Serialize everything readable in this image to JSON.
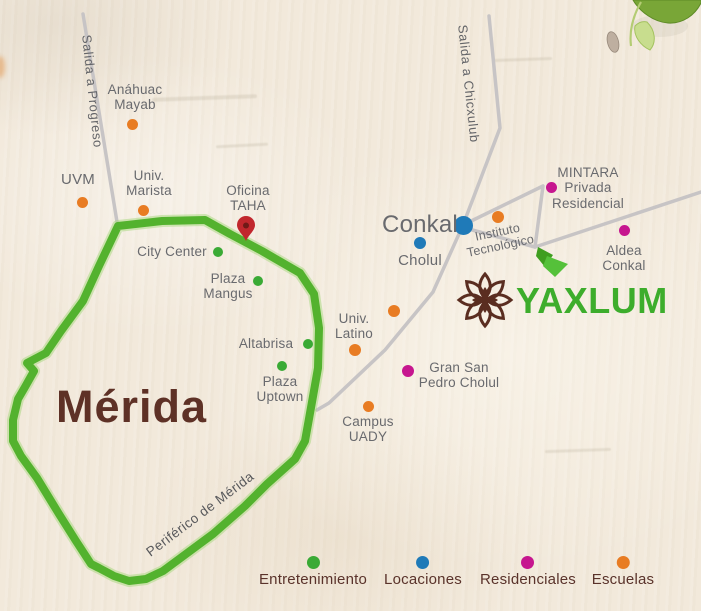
{
  "city_label": "Mérida",
  "ring_label": "Periférico de Mérida",
  "ring_label_pos": {
    "x": 200,
    "y": 514,
    "rotate": -37
  },
  "ring_color": "#53b22e",
  "road_color": "#c7c4c5",
  "road_labels": [
    {
      "id": "salida-progreso",
      "text": "Salida a Progreso",
      "x": 94,
      "y": 34,
      "rotate": 84
    },
    {
      "id": "salida-chicxulub",
      "text": "Salida a Chicxulub",
      "x": 470,
      "y": 24,
      "rotate": 84
    }
  ],
  "office": {
    "lines": [
      "Oficina",
      "TAHA"
    ],
    "label_x": 248,
    "label_y": 183,
    "pin_x": 246,
    "pin_y": 241,
    "pin_color": "#c1272d",
    "pin_hole_color": "#701a17"
  },
  "brand": {
    "name": "YAXLUM",
    "text_color": "#3dad2c",
    "flower_color": "#5a2d20"
  },
  "categories": [
    {
      "id": "entertainment",
      "label": "Entretenimiento",
      "color": "#3aaa35",
      "legend_x": 313
    },
    {
      "id": "location",
      "label": "Locaciones",
      "color": "#1f7ab8",
      "legend_x": 423
    },
    {
      "id": "residential",
      "label": "Residenciales",
      "color": "#c6168f",
      "legend_x": 528
    },
    {
      "id": "school",
      "label": "Escuelas",
      "color": "#e87c23",
      "legend_x": 623
    }
  ],
  "legend": {
    "dot_top": 556,
    "label_top": 571
  },
  "locations": [
    {
      "id": "anahuac-mayab",
      "category": "school",
      "lines": [
        "Anáhuac",
        "Mayab"
      ],
      "dot": {
        "x": 132,
        "y": 124,
        "r": 5.5
      },
      "label": {
        "x": 135,
        "y": 82,
        "size": 13.5
      }
    },
    {
      "id": "uvm",
      "category": "school",
      "lines": [
        "UVM"
      ],
      "dot": {
        "x": 82,
        "y": 202,
        "r": 5.5
      },
      "label": {
        "x": 78,
        "y": 172,
        "size": 15
      }
    },
    {
      "id": "univ-marista",
      "category": "school",
      "lines": [
        "Univ.",
        "Marista"
      ],
      "dot": {
        "x": 143,
        "y": 210,
        "r": 5.5
      },
      "label": {
        "x": 149,
        "y": 168,
        "size": 13.5
      }
    },
    {
      "id": "city-center",
      "category": "entertainment",
      "lines": [
        "City Center"
      ],
      "dot": {
        "x": 218,
        "y": 252,
        "r": 5
      },
      "label": {
        "x": 172,
        "y": 244,
        "size": 13.5
      }
    },
    {
      "id": "plaza-mangus",
      "category": "entertainment",
      "lines": [
        "Plaza",
        "Mangus"
      ],
      "dot": {
        "x": 258,
        "y": 281,
        "r": 5
      },
      "label": {
        "x": 228,
        "y": 271,
        "size": 13.5
      }
    },
    {
      "id": "altabrisa",
      "category": "entertainment",
      "lines": [
        "Altabrisa"
      ],
      "dot": {
        "x": 308,
        "y": 344,
        "r": 5
      },
      "label": {
        "x": 266,
        "y": 336,
        "size": 13.5
      }
    },
    {
      "id": "plaza-uptown",
      "category": "entertainment",
      "lines": [
        "Plaza",
        "Uptown"
      ],
      "dot": {
        "x": 282,
        "y": 366,
        "r": 5
      },
      "label": {
        "x": 280,
        "y": 374,
        "size": 13.5
      }
    },
    {
      "id": "conkal",
      "category": "location",
      "lines": [
        "Conkal"
      ],
      "dot": {
        "x": 463,
        "y": 225,
        "r": 9.5
      },
      "label": {
        "x": 420,
        "y": 211,
        "size": 24
      }
    },
    {
      "id": "cholul",
      "category": "location",
      "lines": [
        "Cholul"
      ],
      "dot": {
        "x": 420,
        "y": 243,
        "r": 6
      },
      "label": {
        "x": 420,
        "y": 253,
        "size": 15
      }
    },
    {
      "id": "instituto-tecnologico",
      "category": "school",
      "lines": [
        "Instituto",
        "Tecnológico"
      ],
      "dot": {
        "x": 498,
        "y": 217,
        "r": 6
      },
      "label": {
        "x": 499,
        "y": 225,
        "size": 12.5,
        "rotate": -12
      }
    },
    {
      "id": "mintara",
      "category": "residential",
      "lines": [
        "MINTARA",
        "Privada",
        "Residencial"
      ],
      "dot": {
        "x": 551,
        "y": 187,
        "r": 5.5
      },
      "label": {
        "x": 588,
        "y": 165,
        "size": 13.5
      }
    },
    {
      "id": "aldea-conkal",
      "category": "residential",
      "lines": [
        "Aldea",
        "Conkal"
      ],
      "dot": {
        "x": 624,
        "y": 230,
        "r": 5.5
      },
      "label": {
        "x": 624,
        "y": 243,
        "size": 13.5
      }
    },
    {
      "id": "univ-latino",
      "category": "school",
      "lines": [
        "Univ.",
        "Latino"
      ],
      "dot": {
        "x": 355,
        "y": 350,
        "r": 6
      },
      "label": {
        "x": 354,
        "y": 311,
        "size": 13.5
      }
    },
    {
      "id": "univ-latino-2",
      "category": "school",
      "lines": [],
      "dot": {
        "x": 394,
        "y": 311,
        "r": 6
      },
      "label": {
        "x": 394,
        "y": 311,
        "size": 13.5
      }
    },
    {
      "id": "gran-san-pedro-cholul",
      "category": "residential",
      "lines": [
        "Gran San",
        "Pedro Cholul"
      ],
      "dot": {
        "x": 408,
        "y": 371,
        "r": 6
      },
      "label": {
        "x": 459,
        "y": 360,
        "size": 13.5
      }
    },
    {
      "id": "campus-uady",
      "category": "school",
      "lines": [
        "Campus",
        "UADY"
      ],
      "dot": {
        "x": 368,
        "y": 406,
        "r": 5.5
      },
      "label": {
        "x": 368,
        "y": 414,
        "size": 13.5
      }
    }
  ]
}
